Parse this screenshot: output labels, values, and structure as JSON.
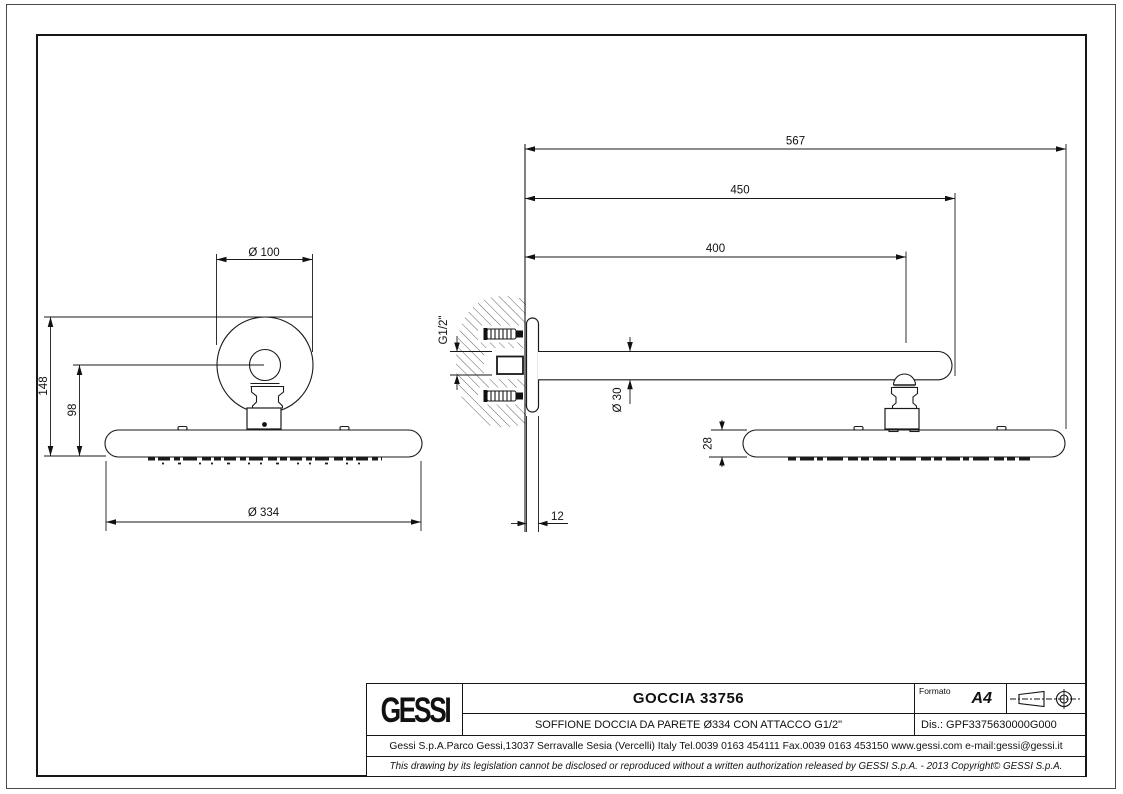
{
  "sheet": {
    "line_color": "#1a1a1a",
    "background": "#ffffff"
  },
  "dims": {
    "flange_diameter": "Ø 100",
    "total_height": "148",
    "center_height": "98",
    "head_diameter": "Ø 334",
    "overall_length": "567",
    "arm_length": "450",
    "length_to_center": "400",
    "arm_diameter": "Ø 30",
    "head_thickness": "28",
    "plate_thickness": "12",
    "thread_size": "G1/2\""
  },
  "title_block": {
    "logo": "GESSI",
    "title": "GOCCIA 33756",
    "subtitle": "SOFFIONE DOCCIA DA PARETE Ø334 CON ATTACCO G1/2\"",
    "formato_label": "Formato",
    "formato_value": "A4",
    "drawing_number": "Dis.: GPF3375630000G000",
    "address": "Gessi S.p.A.Parco Gessi,13037 Serravalle Sesia (Vercelli) Italy Tel.0039 0163 454111 Fax.0039 0163 453150 www.gessi.com e-mail:gessi@gessi.it",
    "disclaimer": "This drawing by its legislation cannot be disclosed or reproduced without a written authorization released by GESSI S.p.A. - 2013 Copyright© GESSI S.p.A."
  }
}
